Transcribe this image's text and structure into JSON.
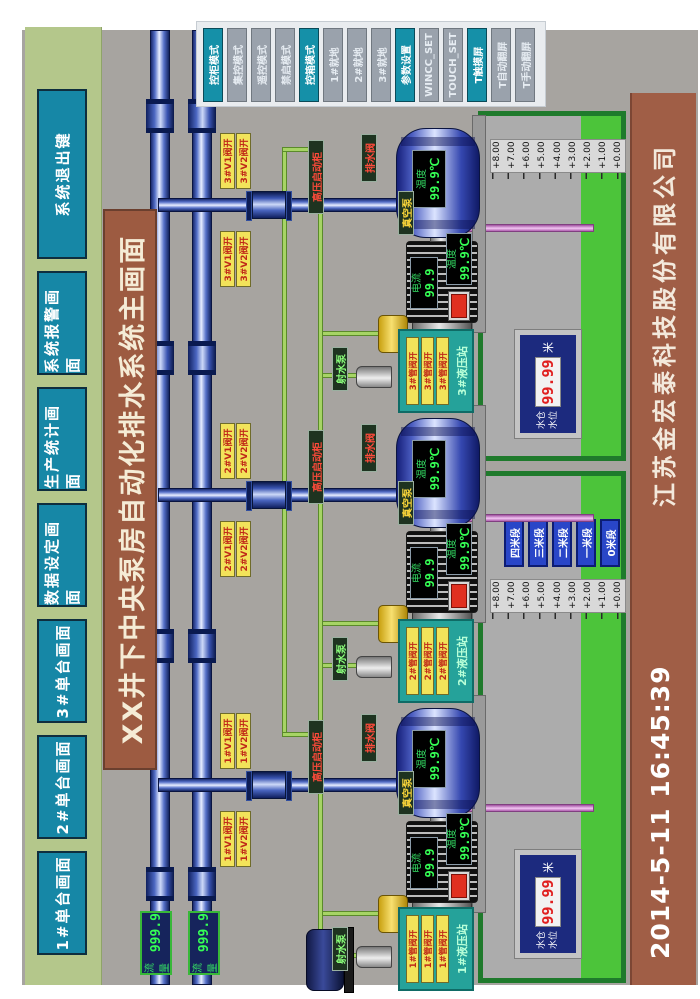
{
  "colors": {
    "accent_teal": "#1687a6",
    "water_green": "#4cc43a",
    "pipe_blue": "#2850b0",
    "alarm_red": "#e03020",
    "bar_brown": "#9d5b41"
  },
  "top_nav": {
    "buttons": [
      {
        "label": "1#单台画面"
      },
      {
        "label": "2#单台画面"
      },
      {
        "label": "3#单台画面"
      },
      {
        "label": "数据设定画面"
      },
      {
        "label": "生产统计画面"
      },
      {
        "label": "系统报警画面"
      },
      {
        "label": "系统退出键"
      }
    ]
  },
  "title_bar": {
    "text": "XX井下中央泵房自动化排水系统主画面"
  },
  "footer": {
    "datetime": "2014-5-11  16:45:39",
    "company": "江苏金宏泰科技股份有限公司"
  },
  "mode_panel": {
    "buttons": [
      {
        "label": "控柜模式",
        "active": true
      },
      {
        "label": "集控模式",
        "active": false
      },
      {
        "label": "遥控模式",
        "active": false
      },
      {
        "label": "禁启模式",
        "active": false
      },
      {
        "label": "控箱模式",
        "active": true
      },
      {
        "label": "1#就地",
        "active": false
      },
      {
        "label": "2#就地",
        "active": false
      },
      {
        "label": "3#就地",
        "active": false
      },
      {
        "label": "参数设置",
        "active": true
      },
      {
        "label": "WINCC_SET",
        "active": false
      },
      {
        "label": "TOUCH_SET",
        "active": false
      },
      {
        "label": "T触摸屏",
        "active": true
      },
      {
        "label": "T自动翻屏",
        "active": false
      },
      {
        "label": "T手动翻屏",
        "active": false
      }
    ]
  },
  "flow_meters": [
    {
      "label": "流量",
      "value": "999.9"
    },
    {
      "label": "流量",
      "value": "999.9"
    }
  ],
  "pumps": [
    {
      "id": "1#",
      "temp_label": "温度",
      "temp_value": "99.9℃",
      "current_label": "电流",
      "current_value": "99.9",
      "motor_temp_label": "温度",
      "motor_temp_value": "99.9℃",
      "valve_tag_1": "1#V1阀开",
      "valve_tag_2": "1#V2阀开",
      "hv_label": "高压启动柜",
      "vacuum_label": "真空泵",
      "jet_label": "射水泵",
      "drain_label": "排水阀",
      "station_title": "1#液压站",
      "station_tags": [
        "1#管阀开",
        "1#管阀开",
        "1#管阀开"
      ]
    },
    {
      "id": "2#",
      "temp_label": "温度",
      "temp_value": "99.9℃",
      "current_label": "电流",
      "current_value": "99.9",
      "motor_temp_label": "温度",
      "motor_temp_value": "99.9℃",
      "valve_tag_1": "2#V1阀开",
      "valve_tag_2": "2#V2阀开",
      "hv_label": "高压启动柜",
      "vacuum_label": "真空泵",
      "jet_label": "射水泵",
      "drain_label": "排水阀",
      "station_title": "2#液压站",
      "station_tags": [
        "2#管阀开",
        "2#管阀开",
        "2#管阀开"
      ]
    },
    {
      "id": "3#",
      "temp_label": "温度",
      "temp_value": "99.9℃",
      "current_label": "电流",
      "current_value": "99.9",
      "motor_temp_label": "温度",
      "motor_temp_value": "99.9℃",
      "valve_tag_1": "3#V1阀开",
      "valve_tag_2": "3#V2阀开",
      "hv_label": "高压启动柜",
      "vacuum_label": "真空泵",
      "jet_label": "射水泵",
      "drain_label": "排水阀",
      "station_title": "3#液压站",
      "station_tags": [
        "3#管阀开",
        "3#管阀开",
        "3#管阀开"
      ]
    }
  ],
  "wells": {
    "ruler_labels": [
      "+8.00",
      "+7.00",
      "+6.00",
      "+5.00",
      "+4.00",
      "+3.00",
      "+2.00",
      "+1.00",
      "+0.00"
    ],
    "stage_buttons": [
      "四米段",
      "三米段",
      "二米段",
      "一米段",
      "0米段"
    ],
    "left": {
      "level_label_1": "水仓",
      "level_label_2": "水位",
      "level_value": "99.99",
      "unit": "米"
    },
    "right": {
      "level_label_1": "水仓",
      "level_label_2": "水位",
      "level_value": "99.99",
      "unit": "米"
    }
  }
}
